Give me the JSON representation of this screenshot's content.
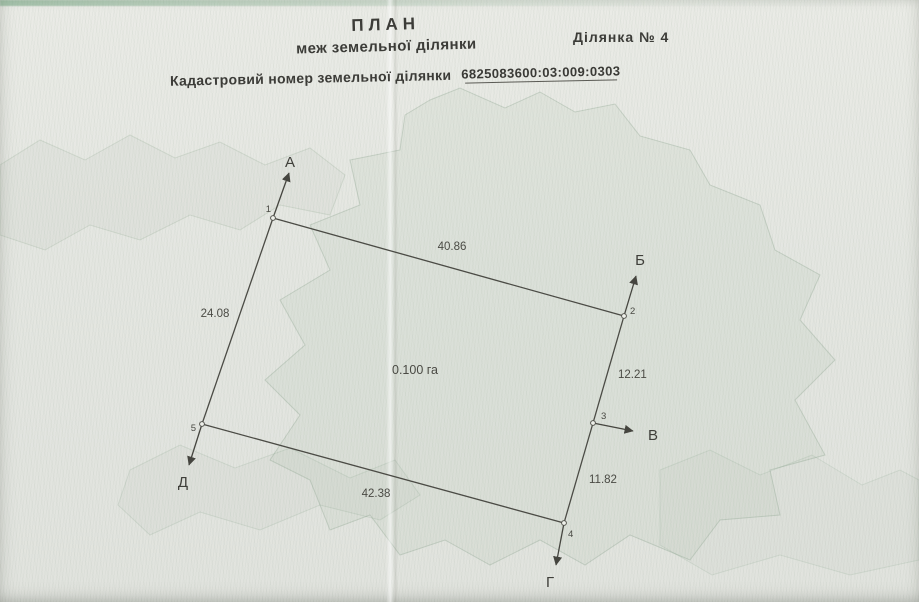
{
  "document": {
    "title_line1": "ПЛАН",
    "title_line2": "меж земельної ділянки",
    "parcel_no": "Ділянка №  4",
    "cadastral_field_label": "Кадастровий номер земельної ділянки",
    "cadastral_number": "6825083600:03:009:0303"
  },
  "plan": {
    "area": "0.100 га",
    "adjacent_labels": {
      "a": "А",
      "b": "Б",
      "v": "В",
      "g": "Г",
      "d": "Д"
    },
    "vertex_numbers": [
      "1",
      "2",
      "3",
      "4",
      "5"
    ],
    "side_lengths": {
      "s12": "40.86",
      "s15": "24.08",
      "s23": "12.21",
      "s34": "11.82",
      "s54": "42.38"
    }
  }
}
